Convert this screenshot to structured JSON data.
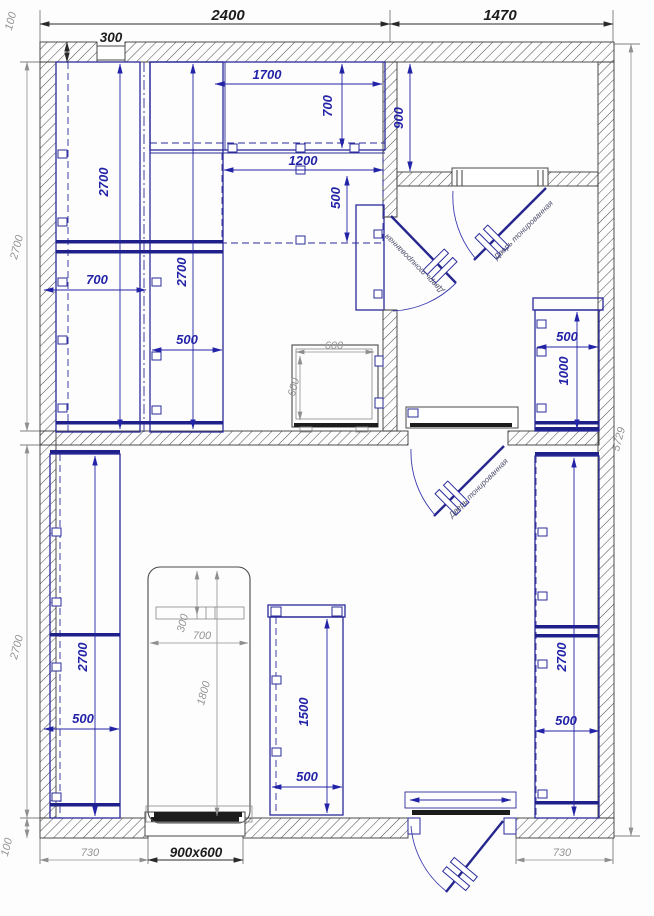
{
  "title": "Floor plan with furniture layout",
  "colors": {
    "furniture_blue": "#2b2b9b",
    "dim_blue": "#2323a8",
    "dim_gray": "#949494",
    "ink_dark": "#1d1d1d",
    "wall": "#3a3a3a"
  },
  "dims": {
    "ext": {
      "top_left": "2400",
      "top_right": "1470",
      "top_wall": "100",
      "top_window": "300",
      "left_upper": "2700",
      "left_lower": "2700",
      "bottom_wall": "100",
      "right_total": "5729",
      "bottom_left": "730",
      "bottom_window": "900x600",
      "bottom_right": "730"
    },
    "tl": {
      "run_w": "1700",
      "run_d": "700",
      "row2_w": "1200",
      "row2_d": "500",
      "wA_h": "2700",
      "wA_w": "700",
      "wB_h": "2700",
      "wB_w": "500",
      "stove_w": "600",
      "stove_d": "600"
    },
    "tr": {
      "depth": "900",
      "cab_w": "500",
      "cab_h": "1000"
    },
    "bt": {
      "lcab_h": "2700",
      "lcab_w": "500",
      "bed_head": "300",
      "bed_w": "700",
      "bed_l": "1800",
      "ccab_h": "1500",
      "ccab_w": "500",
      "rcab_h": "2700",
      "rcab_w": "500"
    }
  },
  "doors": {
    "d1": "Дверь тонированная",
    "d2": "Дверь тонированная",
    "d3": "Дверь тонированная"
  }
}
